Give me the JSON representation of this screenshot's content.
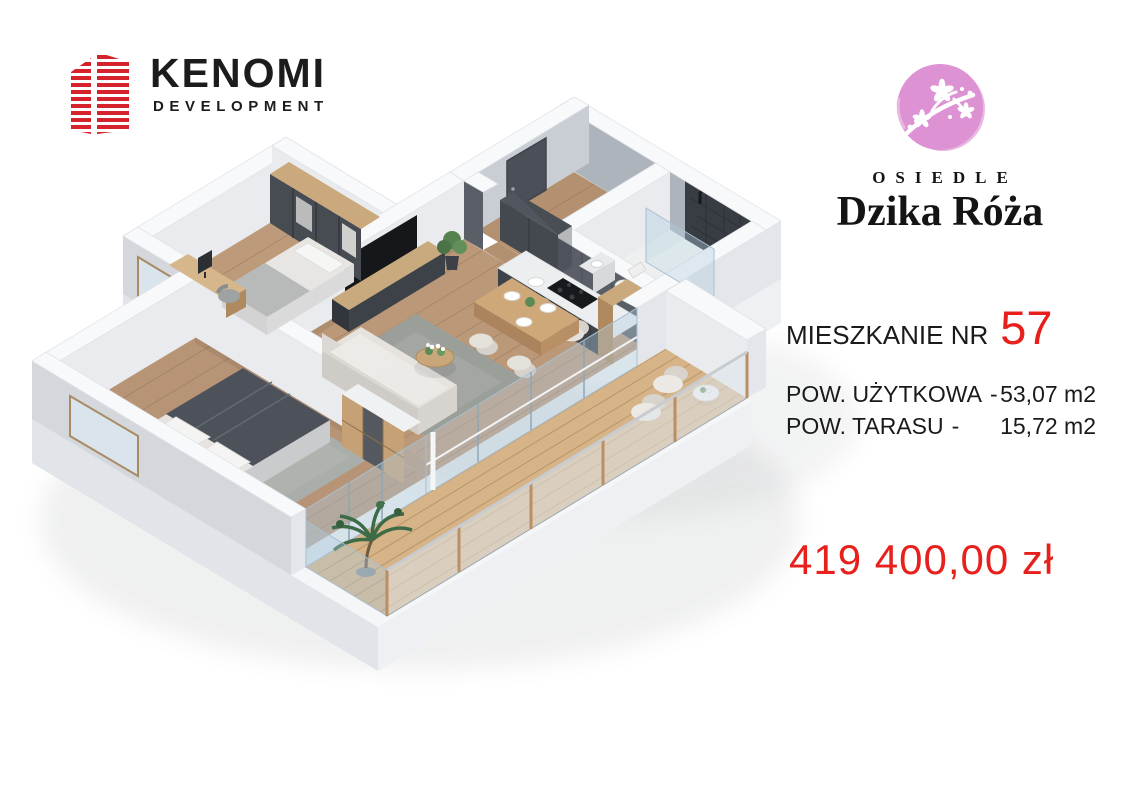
{
  "branding": {
    "developer": {
      "name": "KENOMI",
      "subtitle": "DEVELOPMENT",
      "icon": "red-striped-building-icon"
    },
    "estate": {
      "kicker": "OSIEDLE",
      "name": "Dzika Róża",
      "icon": "pink-blossom-circle-icon"
    }
  },
  "listing": {
    "unit_label": "MIESZKANIE NR",
    "unit_number": "57",
    "areas": [
      {
        "label": "POW. UŻYTKOWA",
        "separator": "-",
        "value": "53,07 m2"
      },
      {
        "label": "POW. TARASU",
        "separator": "-",
        "value": "15,72 m2"
      }
    ],
    "price": "419 400,00 zł"
  },
  "colors": {
    "accent_red": "#e8201c",
    "logo_red": "#d5232b",
    "estate_pink": "#dd92d3"
  },
  "floor_plan": {
    "style": "isometric-3d-apartment-render",
    "rooms": [
      "hallway",
      "bathroom",
      "kitchen",
      "living-room",
      "small-bedroom",
      "master-bedroom",
      "terrace"
    ]
  }
}
